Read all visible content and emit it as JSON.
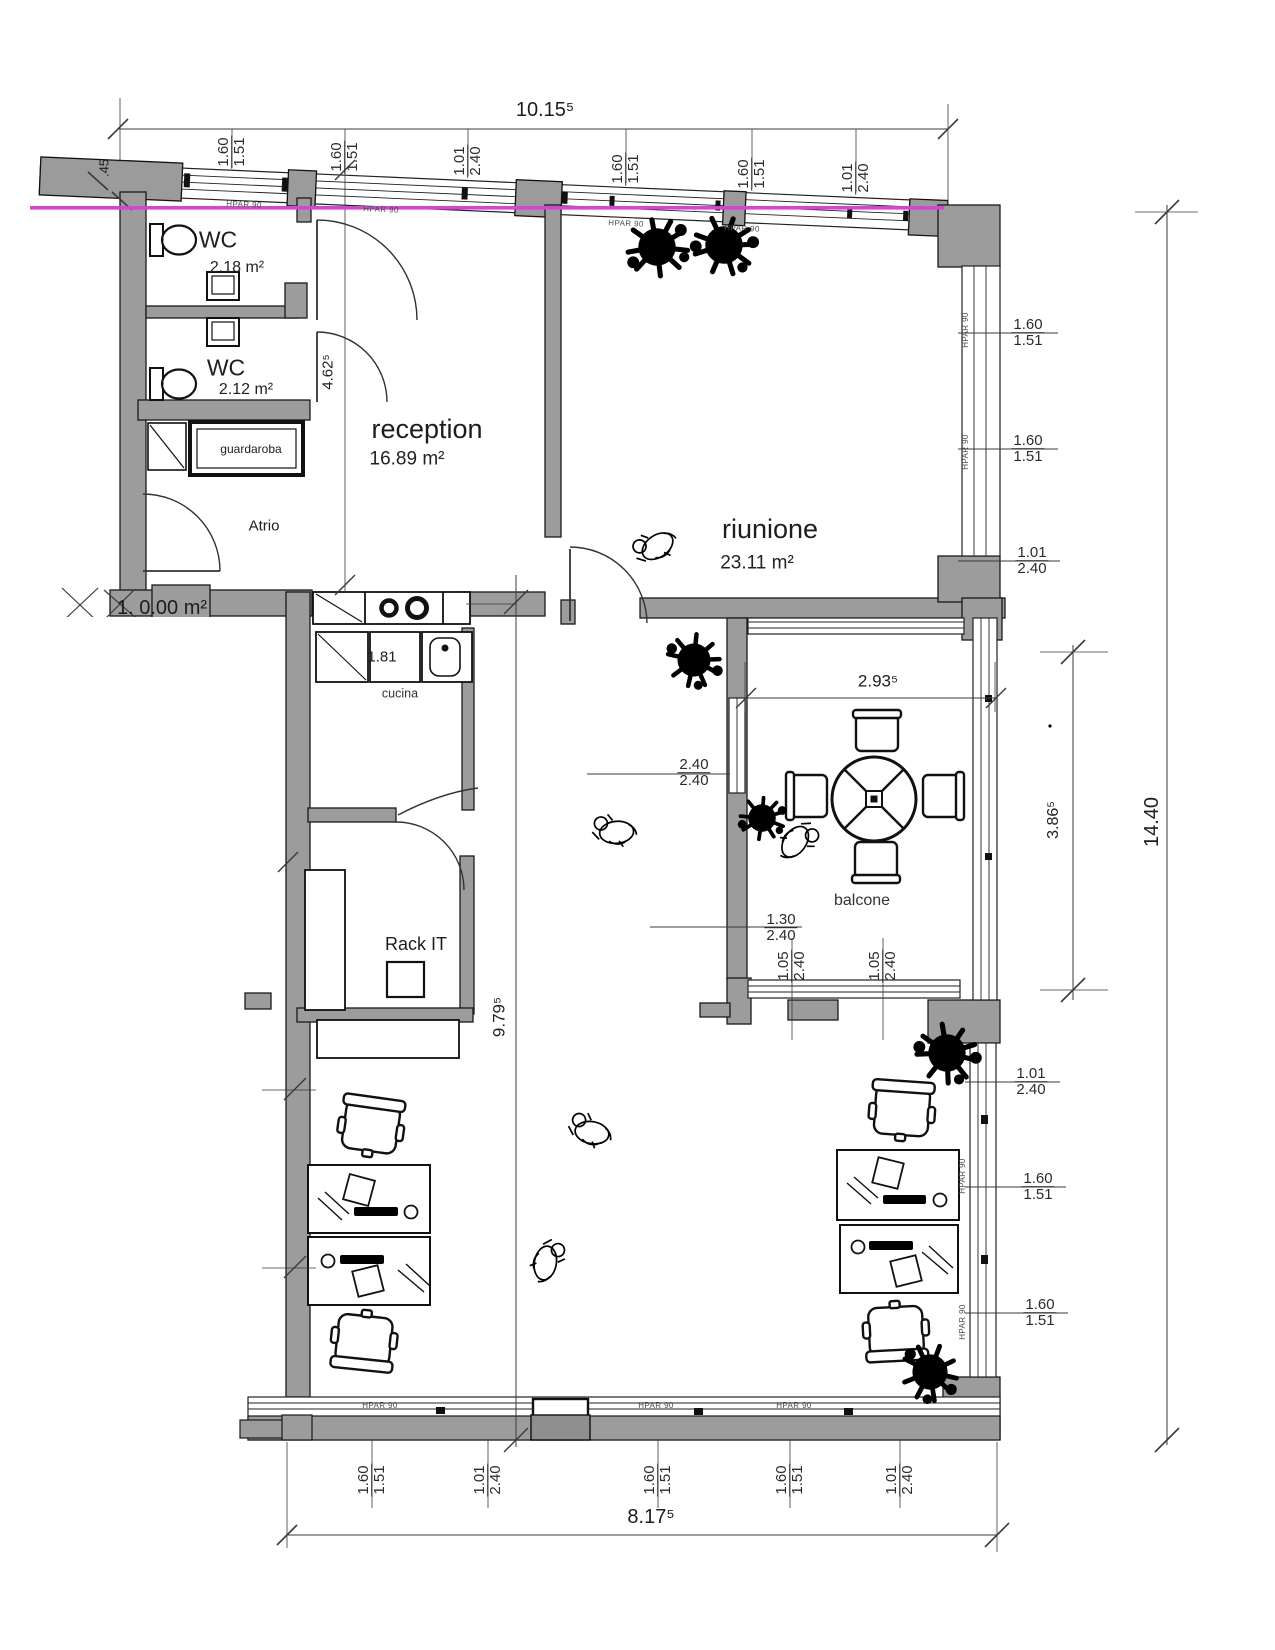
{
  "plan": {
    "window_label": "HPAR 90",
    "colors": {
      "wall_gray": "#9c9c9c",
      "line_black": "#1a1a1a",
      "accent_magenta": "#c84ec8"
    },
    "rooms": {
      "wc1": {
        "name": "WC",
        "area": "2.18 m²"
      },
      "wc2": {
        "name": "WC",
        "area": "2.12 m²"
      },
      "guardaroba": {
        "name": "guardaroba"
      },
      "atrio": {
        "name": "Atrio"
      },
      "reception": {
        "name": "reception",
        "area": "16.89 m²"
      },
      "riunione": {
        "name": "riunione",
        "area": "23.11 m²"
      },
      "cucina": {
        "name": "cucina",
        "counter_value": "1.81"
      },
      "rack_it": {
        "name": "Rack IT"
      },
      "balcone": {
        "name": "balcone"
      },
      "unnamed": {
        "name": "1. 0.00 m²"
      }
    },
    "dimensions": {
      "overall_width_top": "10.15⁵",
      "overall_height_right": "14.40",
      "bottom_width": "8.17⁵",
      "interior_height": "9.79⁵",
      "reception_depth": "4.62⁵",
      "balcone_width": "2.93⁵",
      "balcone_depth": "3.86⁵",
      "wall_stub": ".45"
    },
    "window_dims": {
      "top": [
        {
          "w": "1.60",
          "h": "1.51"
        },
        {
          "w": "1.60",
          "h": "1.51"
        },
        {
          "w": "1.01",
          "h": "2.40"
        },
        {
          "w": "1.60",
          "h": "1.51"
        },
        {
          "w": "1.60",
          "h": "1.51"
        },
        {
          "w": "1.01",
          "h": "2.40"
        }
      ],
      "right_upper": [
        {
          "w": "1.60",
          "h": "1.51"
        },
        {
          "w": "1.60",
          "h": "1.51"
        },
        {
          "w": "1.01",
          "h": "2.40"
        }
      ],
      "right_lower": [
        {
          "w": "1.01",
          "h": "2.40"
        },
        {
          "w": "1.60",
          "h": "1.51"
        },
        {
          "w": "1.60",
          "h": "1.51"
        }
      ],
      "bottom": [
        {
          "w": "1.60",
          "h": "1.51"
        },
        {
          "w": "1.01",
          "h": "2.40"
        },
        {
          "w": "1.60",
          "h": "1.51"
        },
        {
          "w": "1.60",
          "h": "1.51"
        },
        {
          "w": "1.01",
          "h": "2.40"
        }
      ],
      "balcone_left": {
        "w": "2.40",
        "h": "2.40"
      },
      "balcone_bottom_total": {
        "w": "1.30",
        "h": "2.40"
      },
      "balcone_bottom": [
        {
          "w": "1.05",
          "h": "2.40"
        },
        {
          "w": "1.05",
          "h": "2.40"
        }
      ]
    }
  }
}
